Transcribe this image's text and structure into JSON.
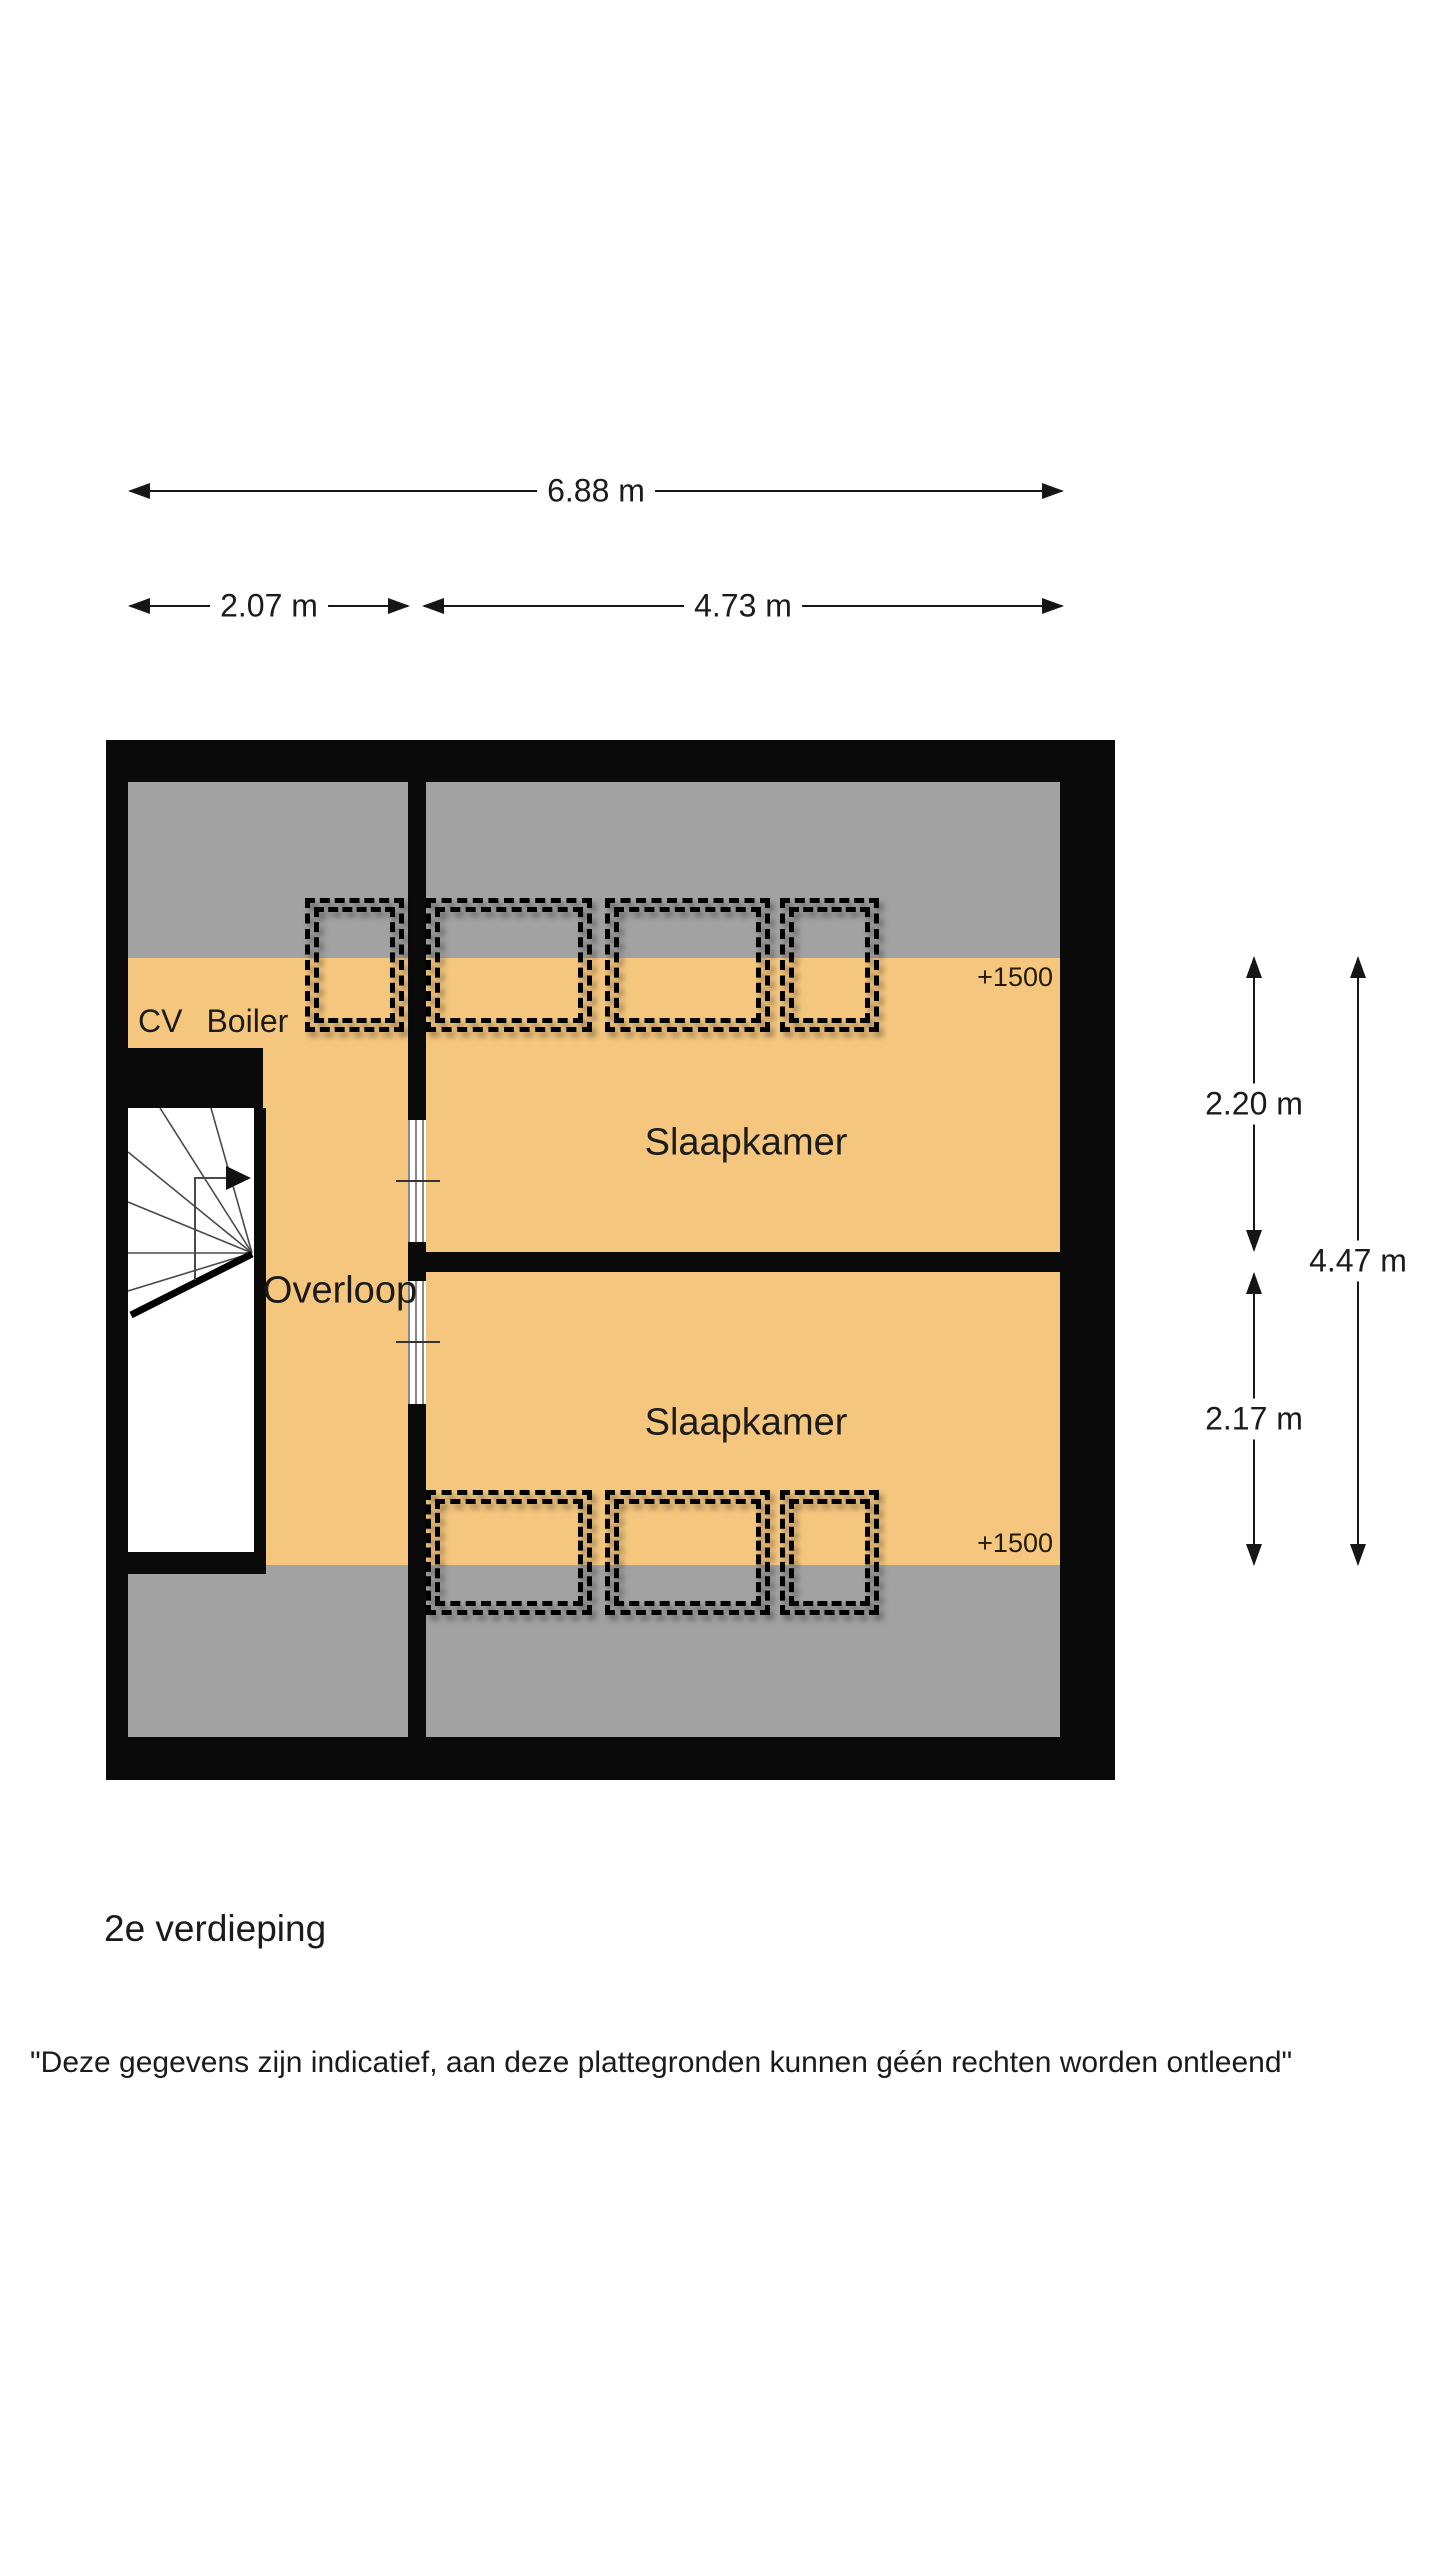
{
  "colors": {
    "wall": "#0a0a0a",
    "zone_orange": "#f5c77e",
    "zone_gray": "#a2a2a2",
    "stair_white": "#ffffff",
    "text_dark": "#1b1b1b",
    "dim_line": "#161616"
  },
  "top_dimensions": {
    "total_width": "6.88 m",
    "left_width": "2.07 m",
    "right_width": "4.73 m"
  },
  "side_dimensions": {
    "upper_height": "2.20 m",
    "lower_height": "2.17 m",
    "total_height": "4.47 m"
  },
  "plan": {
    "cv_label": "CV",
    "boiler_label": "Boiler",
    "landing_label": "Overloop",
    "bedroom_top_label": "Slaapkamer",
    "bedroom_bottom_label": "Slaapkamer",
    "height_marker_top": "+1500",
    "height_marker_bottom": "+1500"
  },
  "footer": {
    "floor_title": "2e verdieping",
    "disclaimer": "\"Deze gegevens zijn indicatief, aan deze plattegronden kunnen géén rechten worden ontleend\""
  }
}
